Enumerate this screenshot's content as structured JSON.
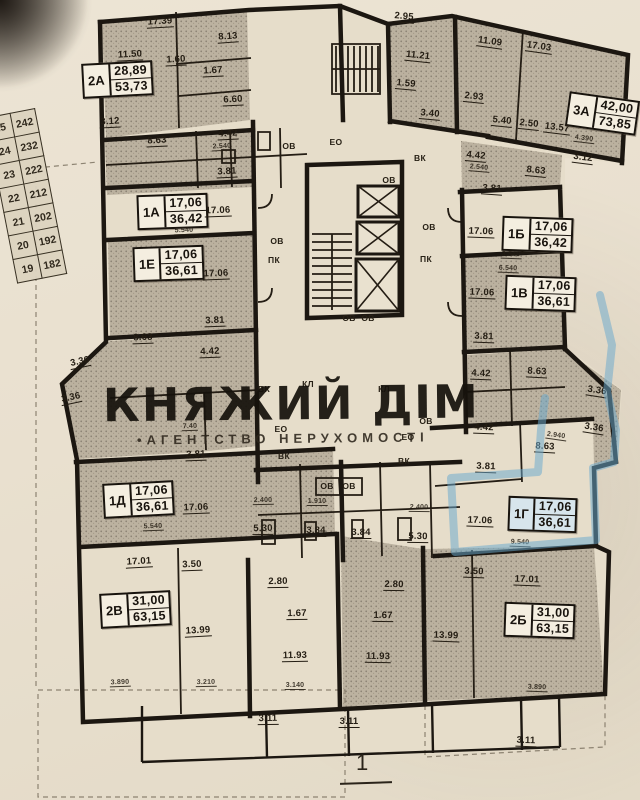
{
  "watermark": {
    "title": "КНЯЖИЙ ДІМ",
    "subtitle": "•АГЕНТСТВО НЕРУХОМОСТІ"
  },
  "page_marker": "1",
  "highlight_color": "#69a8cd",
  "floor_table": {
    "rows": [
      [
        "25",
        "242"
      ],
      [
        "24",
        "232"
      ],
      [
        "23",
        "222"
      ],
      [
        "22",
        "212"
      ],
      [
        "21",
        "202"
      ],
      [
        "20",
        "192"
      ],
      [
        "19",
        "182"
      ]
    ]
  },
  "apartments": [
    {
      "id": "2А",
      "living": "28,89",
      "total": "53,73",
      "x": 82,
      "y": 62,
      "r": -3,
      "hl": false
    },
    {
      "id": "3А",
      "living": "42,00",
      "total": "73,85",
      "x": 567,
      "y": 96,
      "r": 8,
      "hl": false
    },
    {
      "id": "1А",
      "living": "17,06",
      "total": "36,42",
      "x": 137,
      "y": 194,
      "r": -2,
      "hl": false
    },
    {
      "id": "1Е",
      "living": "17,06",
      "total": "36,61",
      "x": 133,
      "y": 246,
      "r": -2,
      "hl": false
    },
    {
      "id": "1Б",
      "living": "17,06",
      "total": "36,42",
      "x": 502,
      "y": 217,
      "r": 2,
      "hl": false
    },
    {
      "id": "1В",
      "living": "17,06",
      "total": "36,61",
      "x": 505,
      "y": 276,
      "r": 2,
      "hl": false
    },
    {
      "id": "1Д",
      "living": "17,06",
      "total": "36,61",
      "x": 103,
      "y": 482,
      "r": -3,
      "hl": false
    },
    {
      "id": "1Г",
      "living": "17,06",
      "total": "36,61",
      "x": 508,
      "y": 497,
      "r": 2,
      "hl": true
    },
    {
      "id": "2В",
      "living": "31,00",
      "total": "63,15",
      "x": 100,
      "y": 592,
      "r": -3,
      "hl": false
    },
    {
      "id": "2Б",
      "living": "31,00",
      "total": "63,15",
      "x": 504,
      "y": 603,
      "r": 2,
      "hl": false
    }
  ],
  "dimensions": [
    {
      "t": "17.39",
      "x": 160,
      "y": 22,
      "r": -3
    },
    {
      "t": "2.95",
      "x": 404,
      "y": 17,
      "r": 5
    },
    {
      "t": "11.50",
      "x": 130,
      "y": 55,
      "r": -3
    },
    {
      "t": "1.60",
      "x": 176,
      "y": 60,
      "r": -3
    },
    {
      "t": "8.13",
      "x": 228,
      "y": 37,
      "r": -4
    },
    {
      "t": "1.67",
      "x": 213,
      "y": 71,
      "r": -3
    },
    {
      "t": "6.60",
      "x": 233,
      "y": 100,
      "r": -3
    },
    {
      "t": "11.21",
      "x": 418,
      "y": 56,
      "r": 6
    },
    {
      "t": "11.09",
      "x": 490,
      "y": 42,
      "r": 8
    },
    {
      "t": "17.03",
      "x": 539,
      "y": 47,
      "r": 8
    },
    {
      "t": "1.59",
      "x": 406,
      "y": 84,
      "r": 5
    },
    {
      "t": "2.93",
      "x": 474,
      "y": 97,
      "r": 6
    },
    {
      "t": "3.40",
      "x": 430,
      "y": 114,
      "r": 5
    },
    {
      "t": "5.40",
      "x": 502,
      "y": 121,
      "r": 6
    },
    {
      "t": "2.50",
      "x": 529,
      "y": 124,
      "r": 6
    },
    {
      "t": "13.57",
      "x": 557,
      "y": 128,
      "r": 7
    },
    {
      "t": "4.390",
      "x": 584,
      "y": 139,
      "r": 7,
      "s": 1
    },
    {
      "t": "3.12",
      "x": 110,
      "y": 122,
      "r": -3
    },
    {
      "t": "8.63",
      "x": 157,
      "y": 141,
      "r": -3
    },
    {
      "t": "4.42",
      "x": 228,
      "y": 134,
      "r": -3
    },
    {
      "t": "2.540",
      "x": 222,
      "y": 147,
      "r": -3,
      "s": 1
    },
    {
      "t": "3.81",
      "x": 227,
      "y": 172,
      "r": -3
    },
    {
      "t": "4.42",
      "x": 476,
      "y": 156,
      "r": 5
    },
    {
      "t": "2.540",
      "x": 479,
      "y": 168,
      "r": 5,
      "s": 1
    },
    {
      "t": "8.63",
      "x": 536,
      "y": 171,
      "r": 6
    },
    {
      "t": "3.12",
      "x": 583,
      "y": 158,
      "r": 7
    },
    {
      "t": "3.81",
      "x": 492,
      "y": 189,
      "r": 4
    },
    {
      "t": "17.06",
      "x": 218,
      "y": 211,
      "r": -2
    },
    {
      "t": "5.540",
      "x": 184,
      "y": 231,
      "r": -2,
      "s": 1
    },
    {
      "t": "17.06",
      "x": 216,
      "y": 274,
      "r": -2
    },
    {
      "t": "3.81",
      "x": 215,
      "y": 321,
      "r": -2
    },
    {
      "t": "8.63",
      "x": 143,
      "y": 338,
      "r": -2
    },
    {
      "t": "4.42",
      "x": 210,
      "y": 352,
      "r": -2
    },
    {
      "t": "7.40",
      "x": 190,
      "y": 427,
      "r": -2,
      "s": 1
    },
    {
      "t": "3.36",
      "x": 80,
      "y": 362,
      "r": -12
    },
    {
      "t": "3.36",
      "x": 71,
      "y": 398,
      "r": -12
    },
    {
      "t": "17.06",
      "x": 481,
      "y": 232,
      "r": 2
    },
    {
      "t": "3.540",
      "x": 511,
      "y": 255,
      "r": 2,
      "s": 1
    },
    {
      "t": "6.540",
      "x": 508,
      "y": 269,
      "r": 2,
      "s": 1
    },
    {
      "t": "17.06",
      "x": 482,
      "y": 293,
      "r": 2
    },
    {
      "t": "3.81",
      "x": 484,
      "y": 337,
      "r": 2
    },
    {
      "t": "4.42",
      "x": 481,
      "y": 374,
      "r": 2
    },
    {
      "t": "8.63",
      "x": 537,
      "y": 372,
      "r": 3
    },
    {
      "t": "3.36",
      "x": 597,
      "y": 391,
      "r": 9
    },
    {
      "t": "3.36",
      "x": 594,
      "y": 428,
      "r": 9
    },
    {
      "t": "2.940",
      "x": 556,
      "y": 436,
      "r": 8,
      "s": 1
    },
    {
      "t": "4.42",
      "x": 484,
      "y": 428,
      "r": 2
    },
    {
      "t": "8.63",
      "x": 545,
      "y": 447,
      "r": 3
    },
    {
      "t": "3.81",
      "x": 486,
      "y": 467,
      "r": 2
    },
    {
      "t": "17.06",
      "x": 480,
      "y": 521,
      "r": 2
    },
    {
      "t": "9.540",
      "x": 520,
      "y": 543,
      "r": 2,
      "s": 1
    },
    {
      "t": "3.81",
      "x": 196,
      "y": 455,
      "r": -2
    },
    {
      "t": "17.06",
      "x": 196,
      "y": 508,
      "r": -2
    },
    {
      "t": "5.540",
      "x": 153,
      "y": 527,
      "r": -2,
      "s": 1
    },
    {
      "t": "2.400",
      "x": 263,
      "y": 501,
      "r": -1,
      "s": 1
    },
    {
      "t": "1.910",
      "x": 317,
      "y": 502,
      "r": 0,
      "s": 1
    },
    {
      "t": "2.400",
      "x": 419,
      "y": 508,
      "r": 1,
      "s": 1
    },
    {
      "t": "5.30",
      "x": 263,
      "y": 529,
      "r": -1
    },
    {
      "t": "3.84",
      "x": 316,
      "y": 531,
      "r": 0
    },
    {
      "t": "3.84",
      "x": 361,
      "y": 533,
      "r": 0
    },
    {
      "t": "5.30",
      "x": 418,
      "y": 537,
      "r": 1
    },
    {
      "t": "2.80",
      "x": 278,
      "y": 582,
      "r": -1
    },
    {
      "t": "2.80",
      "x": 394,
      "y": 585,
      "r": 1
    },
    {
      "t": "1.67",
      "x": 297,
      "y": 614,
      "r": -1
    },
    {
      "t": "1.67",
      "x": 383,
      "y": 616,
      "r": 1
    },
    {
      "t": "17.01",
      "x": 139,
      "y": 562,
      "r": -3
    },
    {
      "t": "3.50",
      "x": 192,
      "y": 565,
      "r": -2
    },
    {
      "t": "3.50",
      "x": 474,
      "y": 572,
      "r": 2
    },
    {
      "t": "17.01",
      "x": 527,
      "y": 580,
      "r": 2
    },
    {
      "t": "13.99",
      "x": 198,
      "y": 631,
      "r": -3
    },
    {
      "t": "13.99",
      "x": 446,
      "y": 636,
      "r": 2
    },
    {
      "t": "11.93",
      "x": 295,
      "y": 656,
      "r": -1
    },
    {
      "t": "11.93",
      "x": 378,
      "y": 657,
      "r": 1
    },
    {
      "t": "3.890",
      "x": 120,
      "y": 683,
      "r": -2,
      "s": 1
    },
    {
      "t": "3.210",
      "x": 206,
      "y": 683,
      "r": -1,
      "s": 1
    },
    {
      "t": "3.140",
      "x": 295,
      "y": 686,
      "r": 0,
      "s": 1
    },
    {
      "t": "3.890",
      "x": 537,
      "y": 688,
      "r": 2,
      "s": 1
    },
    {
      "t": "3.11",
      "x": 268,
      "y": 719,
      "r": -1
    },
    {
      "t": "3.11",
      "x": 349,
      "y": 722,
      "r": 0
    },
    {
      "t": "3.11",
      "x": 526,
      "y": 741,
      "r": 2
    }
  ],
  "utilities": [
    {
      "t": "ОВ",
      "x": 289,
      "y": 146
    },
    {
      "t": "ЕО",
      "x": 336,
      "y": 142
    },
    {
      "t": "ВК",
      "x": 420,
      "y": 158
    },
    {
      "t": "ОВ",
      "x": 389,
      "y": 180
    },
    {
      "t": "ОВ",
      "x": 277,
      "y": 241
    },
    {
      "t": "ПК",
      "x": 274,
      "y": 260
    },
    {
      "t": "ОВ",
      "x": 429,
      "y": 227
    },
    {
      "t": "ПК",
      "x": 426,
      "y": 259
    },
    {
      "t": "ОВ",
      "x": 349,
      "y": 318
    },
    {
      "t": "ОВ",
      "x": 368,
      "y": 318
    },
    {
      "t": "ВК",
      "x": 264,
      "y": 389
    },
    {
      "t": "КЛ",
      "x": 308,
      "y": 384
    },
    {
      "t": "КЛ",
      "x": 384,
      "y": 389
    },
    {
      "t": "ЕО",
      "x": 281,
      "y": 429
    },
    {
      "t": "ОВ",
      "x": 426,
      "y": 421
    },
    {
      "t": "ЕО",
      "x": 408,
      "y": 437
    },
    {
      "t": "ВК",
      "x": 284,
      "y": 456
    },
    {
      "t": "ВК",
      "x": 404,
      "y": 461
    },
    {
      "t": "ОВ",
      "x": 327,
      "y": 486
    },
    {
      "t": "ОВ",
      "x": 349,
      "y": 486
    }
  ]
}
